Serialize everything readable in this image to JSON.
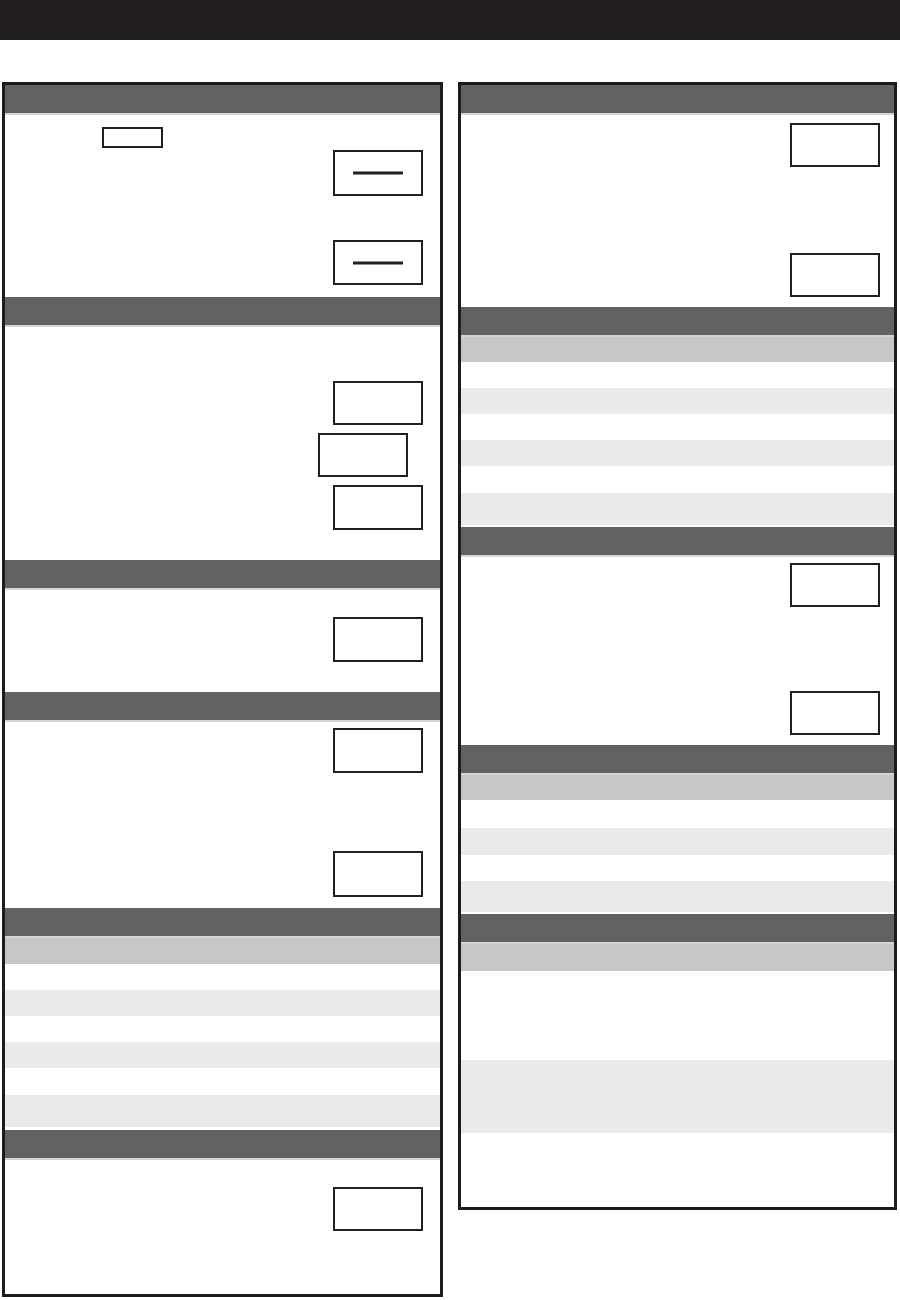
{
  "page": {
    "width": 900,
    "height": 1300,
    "background": "#ffffff"
  },
  "top_banner": {
    "text": "",
    "color": "#231f20"
  },
  "palette": {
    "page_bg": "#ffffff",
    "top_banner_bg": "#231f20",
    "section_header_bg": "#646164",
    "section_header_underline": "#d5d5d5",
    "column_border": "#1d1b1c",
    "table_subheader_bg": "#c7c7c7",
    "row_stripe_bg": "#eaeaea",
    "row_plain_bg": "#ffffff",
    "answer_box_bg": "#ffffff",
    "answer_box_border": "#231f20",
    "blank_line_color": "#231f20"
  },
  "left_panel": {
    "section_header_count": 6,
    "answer_box_count": 9,
    "name_box_count": 1,
    "blank_line_box_count": 2,
    "striped_row_count": 7
  },
  "right_panel": {
    "section_header_count": 5,
    "answer_box_count": 4,
    "striped_row_counts": [
      7,
      5,
      4
    ]
  }
}
